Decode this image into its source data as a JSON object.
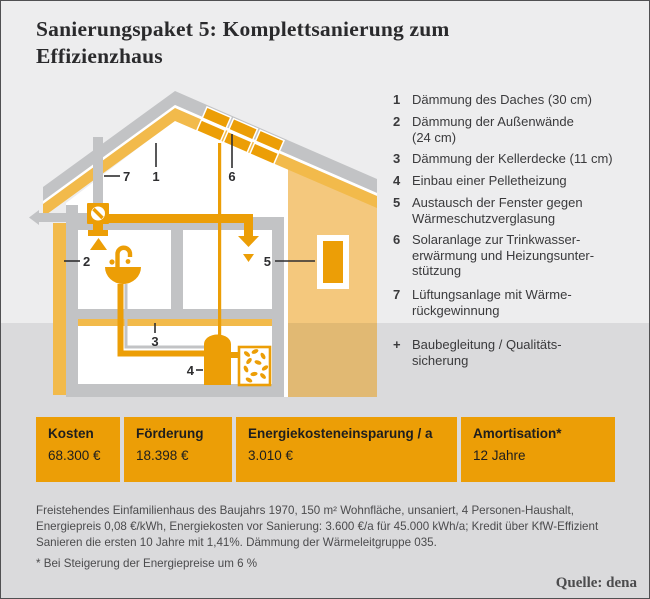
{
  "title": {
    "text": "Sanierungspaket 5: Komplettsanierung zum\nEffizienzhaus"
  },
  "legend": {
    "items": [
      {
        "num": "1",
        "text": "Dämmung des Daches (30 cm)"
      },
      {
        "num": "2",
        "text": "Dämmung der Außenwände\n(24 cm)"
      },
      {
        "num": "3",
        "text": "Dämmung der Kellerdecke (11 cm)"
      },
      {
        "num": "4",
        "text": "Einbau einer Pelletheizung"
      },
      {
        "num": "5",
        "text": "Austausch der Fenster gegen\nWärmeschutzverglasung"
      },
      {
        "num": "6",
        "text": "Solaranlage zur Trinkwasser-\nerwärmung und Heizungsunter-\nstützung"
      },
      {
        "num": "7",
        "text": "Lüftungsanlage mit Wärme-\nrückgewinnung"
      },
      {
        "num": "+",
        "text": "Baubegleitung / Qualitäts-\nsicherung"
      }
    ]
  },
  "house": {
    "labels": [
      "1",
      "2",
      "3",
      "4",
      "5",
      "6",
      "7"
    ]
  },
  "table": {
    "cells": [
      {
        "label": "Kosten",
        "value": "68.300 €"
      },
      {
        "label": "Förderung",
        "value": "18.398 €"
      },
      {
        "label": "Energiekosteneinsparung / a",
        "value": "3.010 €"
      },
      {
        "label": "Amortisation*",
        "value": "12 Jahre"
      }
    ]
  },
  "footer": {
    "description": "Freistehendes Einfamilienhaus des Baujahrs 1970, 150 m² Wohnfläche, unsaniert, 4 Personen-Haushalt,\nEnergiepreis 0,08 €/kWh, Energiekosten vor Sanierung: 3.600 €/a für 45.000 kWh/a; Kredit über KfW-Effizient\nSanieren die ersten 10 Jahre mit 1,41%. Dämmung der Wärmeleitgruppe 035.",
    "footnote": "* Bei Steigerung der Energiepreise um 6 %",
    "source": "Quelle: dena"
  },
  "colors": {
    "accent_orange": "#EC9E06",
    "gold": "#F2BA4B",
    "facade_tan": "#F4C87D",
    "structure_gray": "#C2C3C5",
    "background_light": "#EDEDEE",
    "background_band": "#DADADC",
    "text_dark": "#2A2A2C",
    "text_gray": "#4B4B4D"
  }
}
